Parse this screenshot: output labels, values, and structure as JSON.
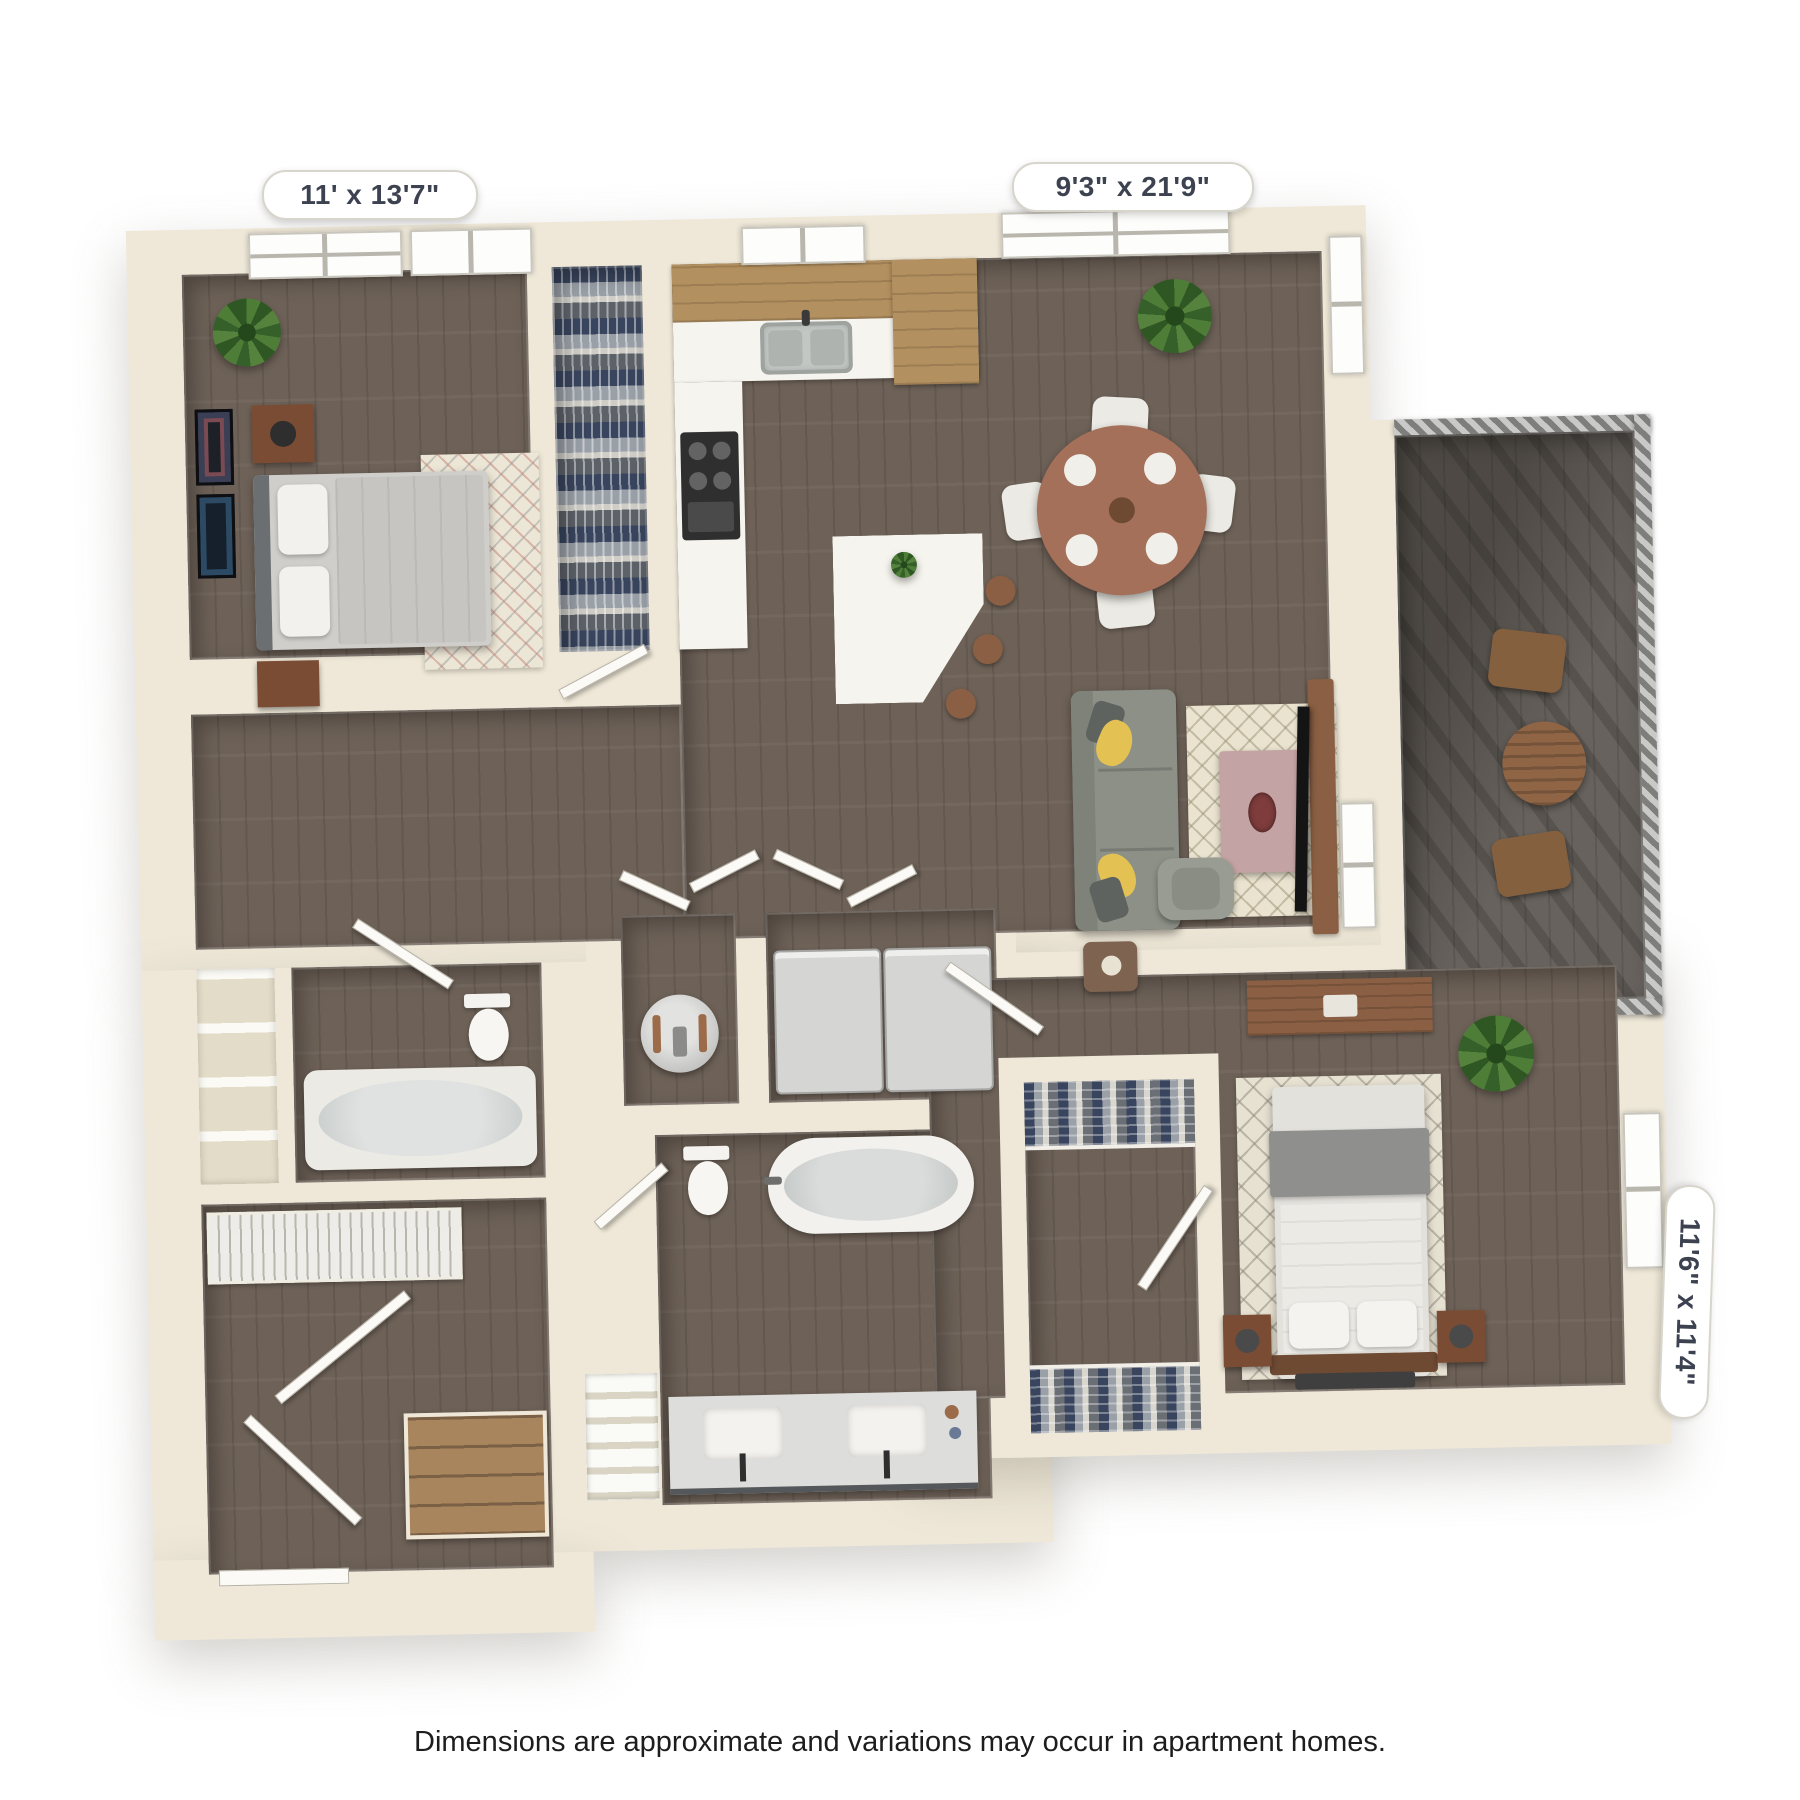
{
  "plan": {
    "dimension_labels": [
      {
        "room": "bedroom-1",
        "text": "11' x 13'7\""
      },
      {
        "room": "kitchen-living-dining",
        "text": "9'3\" x 21'9\""
      },
      {
        "room": "bedroom-2",
        "text": "11'6\" x 11'4\""
      }
    ],
    "disclaimer": "Dimensions are approximate and variations may occur in apartment homes.",
    "style": {
      "wall_color": "#efe8d8",
      "floor_color": "#6e6258",
      "balcony_floor_color": "#67625d",
      "cabinet_wood": "#b3905f",
      "counter_white": "#f6f4ee",
      "sofa_gray": "#8c9087",
      "pillow_yellow": "#e3c253",
      "rug_cream": "#eae3d0",
      "coffee_table_mauve": "#c3a3a3",
      "tv_console_wood": "#8a5a3c",
      "dining_table_wood": "#a4705a",
      "plant_green": "#4e7d38",
      "outdoor_wood": "#8f6546",
      "label_text_color": "#3d4251",
      "disclaimer_color": "#1d1d1d"
    },
    "icons": [
      "bed-icon",
      "sofa-icon",
      "dining-table-icon",
      "bathtub-icon",
      "toilet-icon",
      "sink-icon",
      "washer-icon",
      "dryer-icon",
      "water-heater-icon",
      "plant-icon",
      "stairs-icon",
      "tv-icon",
      "window-icon",
      "door-icon"
    ]
  }
}
